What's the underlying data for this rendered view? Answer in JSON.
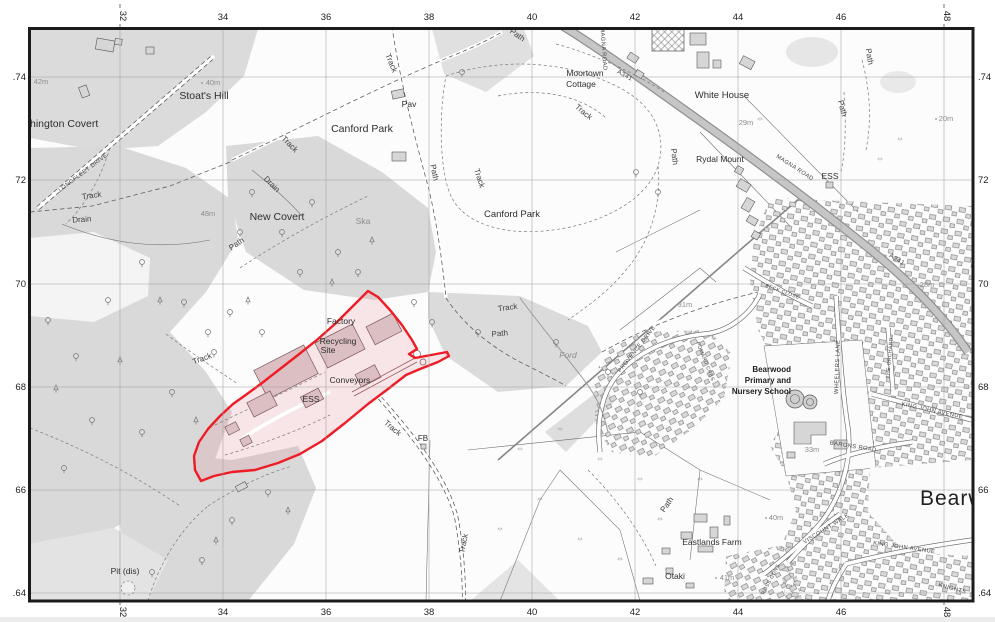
{
  "map": {
    "frame_color": "#1b1b1b",
    "site_boundary_color": "#ee1c25",
    "site_fill_color": "#f5e0e2",
    "grid_top": [
      "32",
      "34",
      "36",
      "38",
      "40",
      "42",
      "44",
      "46",
      "48"
    ],
    "grid_bottom": [
      "32",
      "34",
      "36",
      "38",
      "40",
      "42",
      "44",
      "46",
      "48"
    ],
    "grid_left": [
      ".74",
      "72",
      "70",
      "68",
      "66",
      ".64"
    ],
    "grid_right": [
      ".74",
      "72",
      "70",
      "68",
      "66",
      ".64"
    ],
    "places": {
      "covert_partial": "hington Covert",
      "stoats_hill": "Stoat's Hill",
      "canford_park_a": "Canford Park",
      "canford_park_b": "Canford Park",
      "new_covert": "New Covert",
      "moortown_line1": "Moortown",
      "moortown_line2": "Cottage",
      "white_house": "White House",
      "rydal_mount": "Rydal Mount",
      "ess_magna": "ESS",
      "pav": "Pav",
      "ska": "Ska",
      "ford": "Ford",
      "fb": "FB",
      "pit_dis": "Pit (dis)",
      "eastlands_farm": "Eastlands Farm",
      "otaki": "Otaki",
      "school_line1": "Bearwood",
      "school_line2": "Primary and",
      "school_line3": "Nursery School",
      "bearwood_partial": "Bearw"
    },
    "site_labels": {
      "factory": "Factory",
      "recycling_line1": "Recycling",
      "recycling_line2": "Site",
      "conveyors": "Conveyors",
      "ess": "ESS"
    },
    "route_labels": {
      "track": "Track",
      "path": "Path",
      "drain": "Drain"
    },
    "street_labels": {
      "longfleet_drive": "LONGFLEET DRIVE",
      "magna_road": "MAGNA ROAD",
      "a341": "A341",
      "provence_drive": "PROVENCE DRIVE",
      "pomard_cres": "POMARD CRES",
      "beck_close": "BECK CLOSE",
      "wheelers_lane": "WHEELERS LANE",
      "the_orchard": "THE ORCHARD",
      "king_john_avenue": "KING JOHN AVENUE",
      "barons_road": "BARONS ROAD",
      "viscount_walk": "VISCOUNT WALK",
      "knights": "KNIGHTS",
      "ross_gdns": "ROSS GDNS"
    },
    "spot_heights": {
      "h42": "42m",
      "h40a": "40m",
      "h48": "48m",
      "h29": "29m",
      "h20": "20m",
      "h31": "31m",
      "h28": "28m",
      "h33": "33m",
      "h40b": "40m",
      "h41": "41m"
    }
  }
}
